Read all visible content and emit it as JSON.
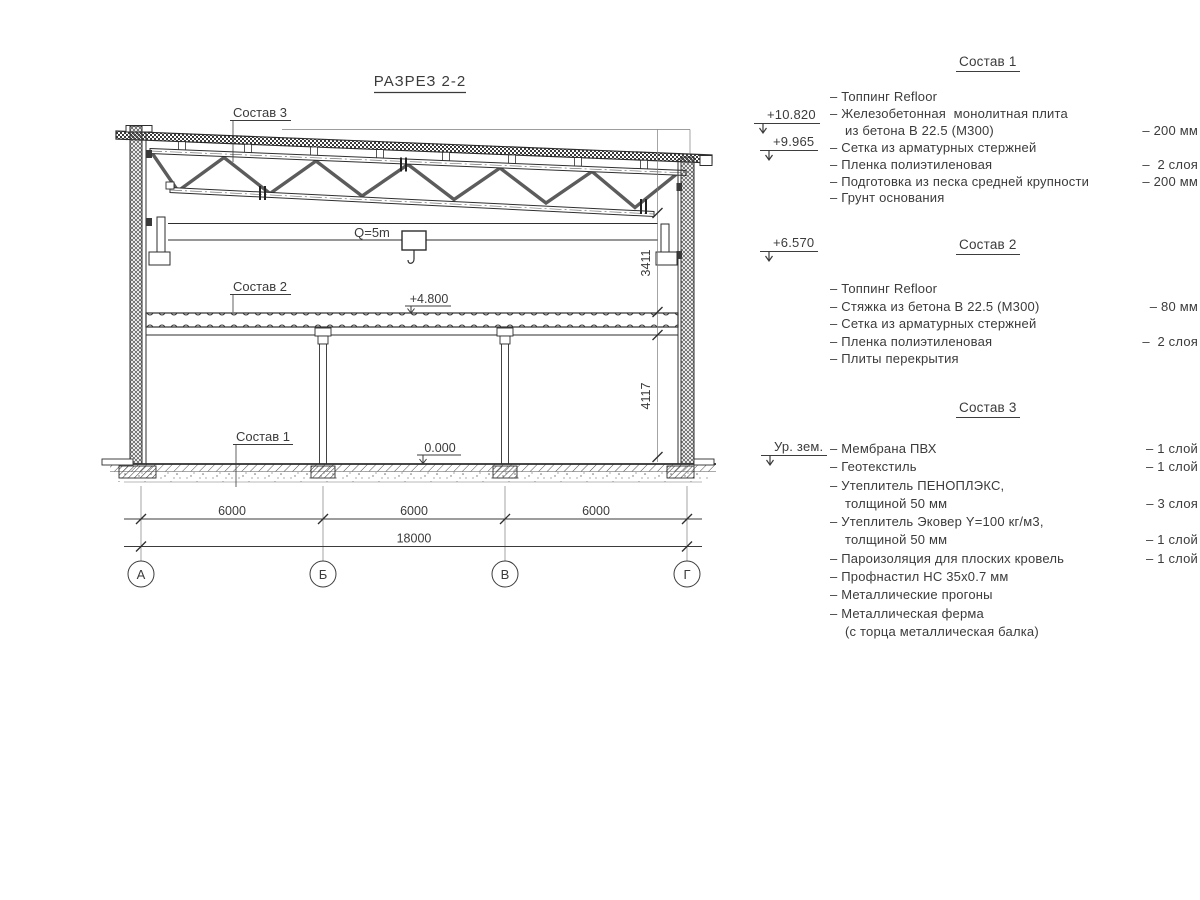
{
  "title": "РАЗРЕЗ 2-2",
  "drawing": {
    "composition_labels": {
      "c1": "Состав 1",
      "c2": "Состав 2",
      "c3": "Состав 3"
    },
    "crane_label": "Q=5m",
    "levels": {
      "floor2": "+4.800",
      "zero": "0.000"
    },
    "vertical_dims": {
      "upper": "3411",
      "lower": "4117"
    },
    "horizontal_dims": {
      "bay1": "6000",
      "bay2": "6000",
      "bay3": "6000",
      "total": "18000"
    },
    "axes": [
      "А",
      "Б",
      "В",
      "Г"
    ]
  },
  "elevation_marks": [
    {
      "label": "+10.820"
    },
    {
      "label": "+9.965"
    },
    {
      "label": "+6.570"
    },
    {
      "label": "Ур. зем."
    }
  ],
  "compositions": [
    {
      "heading": "Состав 1",
      "items": [
        {
          "text": "– Топпинг Refloor",
          "value": ""
        },
        {
          "text": "– Железобетонная  монолитная плита",
          "value": ""
        },
        {
          "text": "из бетона В 22.5 (М300)",
          "value": "– 200 мм",
          "cont": true
        },
        {
          "text": "– Сетка из арматурных стержней",
          "value": ""
        },
        {
          "text": "– Пленка полиэтиленовая",
          "value": "–  2 слоя"
        },
        {
          "text": "– Подготовка из песка средней крупности",
          "value": "– 200 мм"
        },
        {
          "text": "– Грунт основания",
          "value": ""
        }
      ]
    },
    {
      "heading": "Состав 2",
      "items": [
        {
          "text": "– Топпинг Refloor",
          "value": ""
        },
        {
          "text": "– Стяжка из бетона В 22.5 (М300)",
          "value": "– 80 мм"
        },
        {
          "text": "– Сетка из арматурных стержней",
          "value": ""
        },
        {
          "text": "– Пленка полиэтиленовая",
          "value": "–  2 слоя"
        },
        {
          "text": "– Плиты перекрытия",
          "value": ""
        }
      ]
    },
    {
      "heading": "Состав 3",
      "items": [
        {
          "text": "– Мембрана ПВХ",
          "value": "– 1 слой"
        },
        {
          "text": "– Геотекстиль",
          "value": "– 1 слой"
        },
        {
          "text": "– Утеплитель ПЕНОПЛЭКС,",
          "value": ""
        },
        {
          "text": "толщиной 50 мм",
          "value": "– 3 слоя",
          "cont": true
        },
        {
          "text": "– Утеплитель Эковер Y=100 кг/м3,",
          "value": ""
        },
        {
          "text": "толщиной 50 мм",
          "value": "– 1 слой",
          "cont": true
        },
        {
          "text": "– Пароизоляция для плоских кровель",
          "value": "– 1 слой"
        },
        {
          "text": "– Профнастил НС 35х0.7 мм",
          "value": ""
        },
        {
          "text": "– Металлические прогоны",
          "value": ""
        },
        {
          "text": "– Металлическая ферма",
          "value": ""
        },
        {
          "text": "(с торца металлическая балка)",
          "value": "",
          "cont": true
        }
      ]
    }
  ]
}
